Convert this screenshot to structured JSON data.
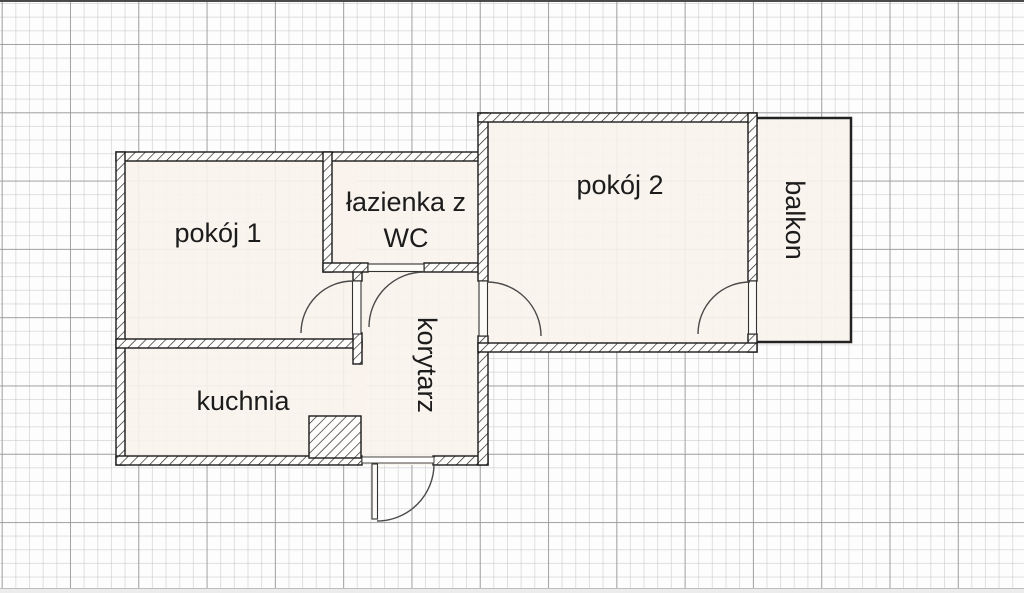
{
  "floorplan": {
    "rooms": {
      "pokoj1": {
        "label": "pokój 1"
      },
      "lazienka": {
        "line1": "łazienka z",
        "line2": "WC"
      },
      "pokoj2": {
        "label": "pokój 2"
      },
      "balkon": {
        "label": "balkon"
      },
      "korytarz": {
        "label": "korytarz"
      },
      "kuchnia": {
        "label": "kuchnia"
      }
    },
    "colors": {
      "room_fill": "#faf3ec",
      "wall_line": "#1a1a1a",
      "door_arc": "#4a4a4a",
      "grid_minor": "#c6c6c6",
      "grid_major": "#949494",
      "text": "#1c1c1c"
    }
  }
}
